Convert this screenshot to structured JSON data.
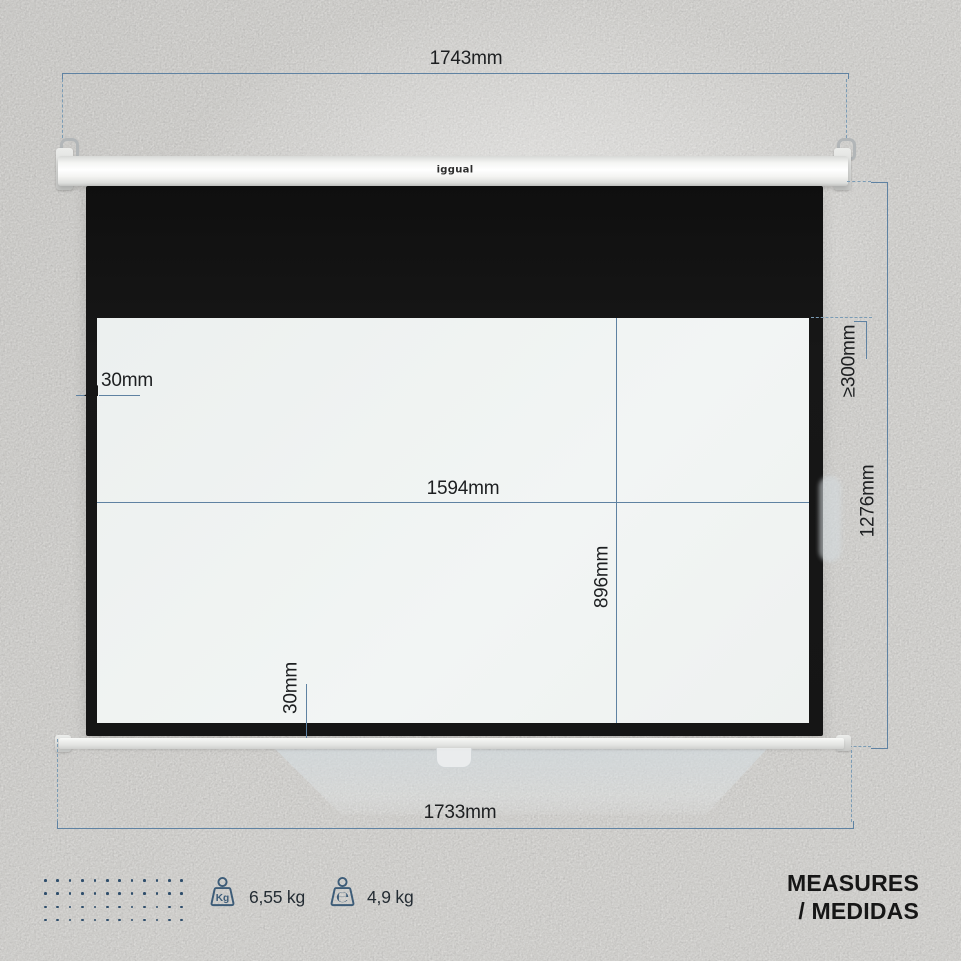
{
  "product": {
    "brand_logo": "iggual",
    "type": "projection-screen-measurement-diagram"
  },
  "dimensions": {
    "top_width": "1743mm",
    "bottom_width": "1733mm",
    "total_height": "1276mm",
    "min_top_drop": "≥300mm",
    "viewing_width": "1594mm",
    "viewing_height": "896mm",
    "border_side": "30mm",
    "border_bottom": "30mm"
  },
  "footer": {
    "weights": [
      {
        "icon": "kg-weight-icon",
        "glyph": "Kg",
        "value": "6,55 kg"
      },
      {
        "icon": "estimated-weight-icon",
        "glyph": "℮",
        "value": "4,9 kg"
      }
    ],
    "title_line1": "MEASURES",
    "title_line2": "/ MEDIDAS",
    "dots": {
      "rows": 4,
      "cols": 12
    }
  },
  "colors": {
    "background": "#f2f1ee",
    "dimension_line": "#5f82a2",
    "dimension_dashed": "#7b9cb5",
    "screen_black": "#151515",
    "screen_white": "#eff2f1",
    "icon_blue": "#3d5c78",
    "dot_navy": "#2e4d6b",
    "text": "#1d1f21"
  }
}
